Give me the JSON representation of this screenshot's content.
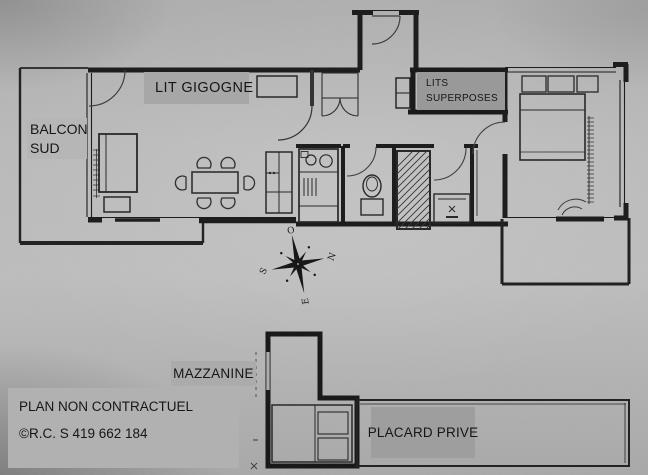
{
  "plan": {
    "room_labels": {
      "lit_gigogne": "LIT GIGOGNE",
      "balcon": {
        "line1": "BALCON",
        "line2": "SUD"
      },
      "lits_superposes": {
        "line1": "LITS",
        "line2": "SUPERPOSES"
      },
      "mazzanine": "MAZZANINE",
      "placard_prive": "PLACARD PRIVE"
    },
    "footer": {
      "disclaimer": "PLAN NON CONTRACTUEL",
      "registration": "©R.C. S 419 662 184"
    },
    "compass": {
      "west": "O",
      "north": "N",
      "south": "S",
      "east": "E"
    },
    "colors": {
      "background": "#b4b4b4",
      "ink": "#161616",
      "label_gray": "#a7a7a7",
      "label_dark_gray": "#999999",
      "label_light_gray": "#b6b6b6"
    }
  }
}
